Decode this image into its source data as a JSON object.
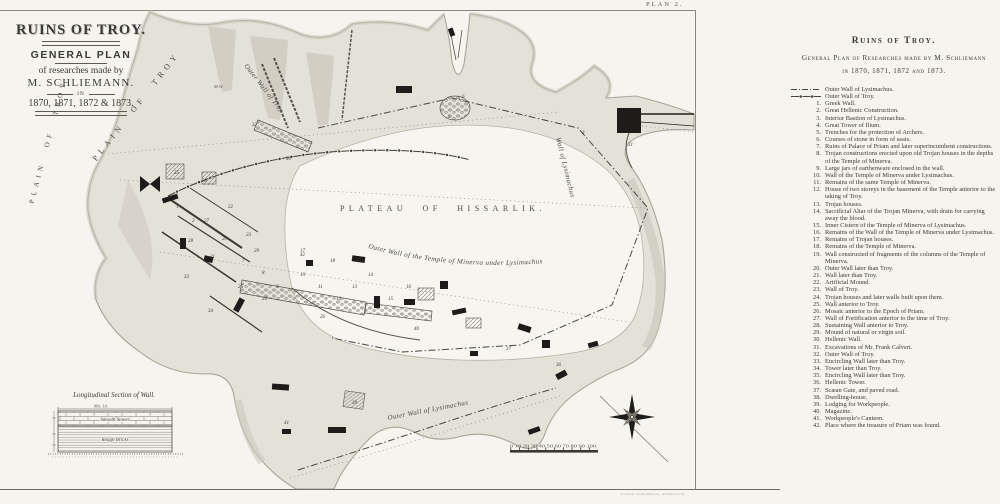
{
  "plate": {
    "label": "PLAN 2.",
    "imprint": "London: John Murray, Albemarle St."
  },
  "title_block": {
    "line1": "RUINS OF TROY.",
    "line2": "GENERAL PLAN",
    "line3": "of researches made by",
    "line4": "M. SCHLIEMANN.",
    "line5": "IN",
    "line6": "1870, 1871, 1872 & 1873."
  },
  "map": {
    "labels": {
      "plain_of_troy": "PLAIN OF TROY",
      "plain_of_troy_2": "PLAIN OF TROY",
      "plateau": "PLATEAU OF HISSARLIK.",
      "temple_wall": "Outer Wall of the Temple of Minerva under Lysimachus",
      "lysimachus_wall": "Outer Wall of Lysimachus",
      "troy_wall": "Outer Wall of Troy",
      "right_wall": "Wall of Lysimachus",
      "mw": "M.W."
    },
    "section": {
      "title": "Longitudinal Section of Wall.",
      "measure": "Mtr. 10.",
      "upper": "Smooth Stones",
      "lower": "Rough Bricks"
    },
    "scalebar": {
      "numbers": "0 10 20 30 40 50 60 70 80 90 100"
    },
    "numbers": [
      [
        1,
        176,
        208
      ],
      [
        2,
        192,
        222
      ],
      [
        3,
        582,
        134
      ],
      [
        4,
        398,
        92
      ],
      [
        5,
        448,
        118
      ],
      [
        6,
        462,
        98
      ],
      [
        7,
        242,
        262
      ],
      [
        8,
        262,
        274
      ],
      [
        9,
        276,
        288
      ],
      [
        10,
        300,
        276
      ],
      [
        11,
        318,
        288
      ],
      [
        12,
        336,
        300
      ],
      [
        13,
        352,
        288
      ],
      [
        14,
        368,
        276
      ],
      [
        15,
        388,
        300
      ],
      [
        16,
        406,
        288
      ],
      [
        17,
        300,
        252
      ],
      [
        18,
        330,
        262
      ],
      [
        19,
        356,
        262
      ],
      [
        20,
        222,
        240
      ],
      [
        21,
        210,
        258
      ],
      [
        22,
        228,
        208
      ],
      [
        23,
        246,
        236
      ],
      [
        24,
        262,
        300
      ],
      [
        25,
        238,
        288
      ],
      [
        26,
        320,
        318
      ],
      [
        27,
        204,
        222
      ],
      [
        28,
        188,
        242
      ],
      [
        29,
        254,
        252
      ],
      [
        30,
        286,
        160
      ],
      [
        31,
        628,
        146
      ],
      [
        32,
        252,
        126
      ],
      [
        33,
        184,
        278
      ],
      [
        34,
        208,
        312
      ],
      [
        35,
        174,
        174
      ],
      [
        36,
        556,
        366
      ],
      [
        37,
        506,
        350
      ],
      [
        38,
        202,
        182
      ],
      [
        39,
        352,
        404
      ],
      [
        40,
        414,
        330
      ],
      [
        41,
        284,
        424
      ],
      [
        42,
        300,
        256
      ]
    ]
  },
  "legend": {
    "header1": "Ruins of Troy.",
    "header2": "General Plan of Researches made by M. Schliemann",
    "header3": "in 1870, 1871, 1872 and 1873.",
    "symbols": [
      {
        "label": "Outer Wall of Lysimachus."
      },
      {
        "label": "Outer Wall of Troy."
      }
    ],
    "items": [
      {
        "num": 1,
        "text": "Greek Wall."
      },
      {
        "num": 2,
        "text": "Great Hellenic Construction."
      },
      {
        "num": 3,
        "text": "Interior Bastion of Lysimachus."
      },
      {
        "num": 4,
        "text": "Great Tower of Ilium."
      },
      {
        "num": 5,
        "text": "Trenches for the protection of Archers."
      },
      {
        "num": 6,
        "text": "Courses of stone in form of seats."
      },
      {
        "num": 7,
        "text": "Ruins of Palace of Priam and later superincumbent constructions."
      },
      {
        "num": 8,
        "text": "Trojan constructions erected upon old Trojan houses in the depths of the Temple of Minerva."
      },
      {
        "num": 9,
        "text": "Large jars of earthenware enclosed in the wall."
      },
      {
        "num": 10,
        "text": "Wall of the Temple of Minerva under Lysimachus."
      },
      {
        "num": 11,
        "text": "Remains of the same Temple of Minerva."
      },
      {
        "num": 12,
        "text": "House of two storeys in the basement of the Temple anterior to the taking of Troy."
      },
      {
        "num": 13,
        "text": "Trojan houses."
      },
      {
        "num": 14,
        "text": "Sacrificial Altar of the Trojan Minerva, with drain for carrying away the blood."
      },
      {
        "num": 15,
        "text": "Inner Cistern of the Temple of Minerva of Lysimachus."
      },
      {
        "num": 16,
        "text": "Remains of the Wall of the Temple of Minerva under Lysimachus."
      },
      {
        "num": 17,
        "text": "Remains of Trojan houses."
      },
      {
        "num": 18,
        "text": "Remains of the Temple of Minerva."
      },
      {
        "num": 19,
        "text": "Wall constructed of fragments of the columns of the Temple of Minerva."
      },
      {
        "num": 20,
        "text": "Outer Wall later than Troy."
      },
      {
        "num": 21,
        "text": "Wall later than Troy."
      },
      {
        "num": 22,
        "text": "Artificial Mound."
      },
      {
        "num": 23,
        "text": "Wall of Troy."
      },
      {
        "num": 24,
        "text": "Trojan houses and later walls built upon them."
      },
      {
        "num": 25,
        "text": "Wall anterior to Troy."
      },
      {
        "num": 26,
        "text": "Mosaic anterior to the Epoch of Priam."
      },
      {
        "num": 27,
        "text": "Wall of Fortification anterior to the time of Troy."
      },
      {
        "num": 28,
        "text": "Sustaining Wall anterior to Troy."
      },
      {
        "num": 29,
        "text": "Mound of natural or virgin soil."
      },
      {
        "num": 30,
        "text": "Hellenic Wall."
      },
      {
        "num": 31,
        "text": "Excavations of Mr. Frank Calvert."
      },
      {
        "num": 32,
        "text": "Outer Wall of Troy."
      },
      {
        "num": 33,
        "text": "Encircling Wall later than Troy."
      },
      {
        "num": 34,
        "text": "Tower later than Troy."
      },
      {
        "num": 35,
        "text": "Encircling Wall later than Troy."
      },
      {
        "num": 36,
        "text": "Hellenic Tower."
      },
      {
        "num": 37,
        "text": "Scæan Gate, and paved road."
      },
      {
        "num": 38,
        "text": "Dwelling-house."
      },
      {
        "num": 39,
        "text": "Lodging for Workpeople."
      },
      {
        "num": 40,
        "text": "Magazine."
      },
      {
        "num": 41,
        "text": "Workpeople's Canteen."
      },
      {
        "num": 42,
        "text": "Place where the treasure of Priam was found."
      }
    ]
  },
  "colors": {
    "paper": "#f5f4ef",
    "terrain": "#e4e1d9",
    "slope": "#cfcbc0",
    "ink": "#2e2c28"
  }
}
